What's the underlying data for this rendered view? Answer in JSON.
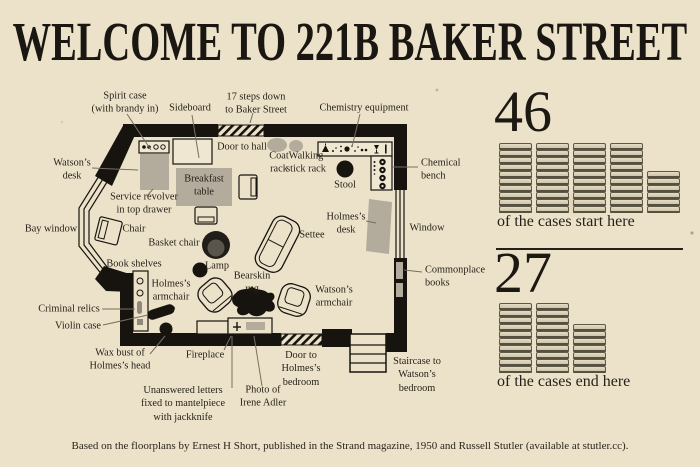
{
  "title": "WELCOME TO 221B BAKER STREET",
  "floorplan": {
    "labels": [
      {
        "id": "spirit-case",
        "text": "Spirit case\n(with brandy in)",
        "x": 125,
        "y": 103,
        "align": "center"
      },
      {
        "id": "sideboard",
        "text": "Sideboard",
        "x": 190,
        "y": 108,
        "align": "center"
      },
      {
        "id": "steps-to-baker-street",
        "text": "17 steps down\nto Baker Street",
        "x": 256,
        "y": 104,
        "align": "center"
      },
      {
        "id": "chemistry-equipment",
        "text": "Chemistry equipment",
        "x": 364,
        "y": 108,
        "align": "center"
      },
      {
        "id": "door-to-hall",
        "text": "Door to hall",
        "x": 242,
        "y": 147,
        "align": "center"
      },
      {
        "id": "coat-rack",
        "text": "Coat\nrack",
        "x": 279,
        "y": 163,
        "align": "center"
      },
      {
        "id": "walking-stick-rack",
        "text": "Walking\nstick rack",
        "x": 306,
        "y": 163,
        "align": "center"
      },
      {
        "id": "stool",
        "text": "Stool",
        "x": 345,
        "y": 185,
        "align": "center"
      },
      {
        "id": "chemical-bench",
        "text": "Chemical\nbench",
        "x": 421,
        "y": 170,
        "align": "left"
      },
      {
        "id": "watsons-desk",
        "text": "Watson’s\ndesk",
        "x": 72,
        "y": 170,
        "align": "center"
      },
      {
        "id": "service-revolver",
        "text": "Service revolver\nin top drawer",
        "x": 144,
        "y": 204,
        "align": "center"
      },
      {
        "id": "breakfast-table",
        "text": "Breakfast\ntable",
        "x": 204,
        "y": 186,
        "align": "center"
      },
      {
        "id": "bay-window",
        "text": "Bay window",
        "x": 51,
        "y": 229,
        "align": "center"
      },
      {
        "id": "chair",
        "text": "Chair",
        "x": 134,
        "y": 229,
        "align": "center"
      },
      {
        "id": "basket-chair",
        "text": "Basket chair",
        "x": 174,
        "y": 243,
        "align": "center"
      },
      {
        "id": "settee",
        "text": "Settee",
        "x": 312,
        "y": 235,
        "align": "center"
      },
      {
        "id": "holmes-desk",
        "text": "Holmes’s\ndesk",
        "x": 346,
        "y": 224,
        "align": "center"
      },
      {
        "id": "window",
        "text": "Window",
        "x": 427,
        "y": 228,
        "align": "center"
      },
      {
        "id": "book-shelves",
        "text": "Book shelves",
        "x": 134,
        "y": 264,
        "align": "center"
      },
      {
        "id": "lamp",
        "text": "Lamp",
        "x": 217,
        "y": 266,
        "align": "center"
      },
      {
        "id": "bearskin-rug",
        "text": "Bearskin\nrug",
        "x": 252,
        "y": 283,
        "align": "center"
      },
      {
        "id": "commonplace-books",
        "text": "Commonplace\nbooks",
        "x": 425,
        "y": 277,
        "align": "left"
      },
      {
        "id": "holmes-armchair",
        "text": "Holmes’s\narmchair",
        "x": 171,
        "y": 291,
        "align": "center"
      },
      {
        "id": "watsons-armchair",
        "text": "Watson’s\narmchair",
        "x": 334,
        "y": 297,
        "align": "center"
      },
      {
        "id": "criminal-relics",
        "text": "Criminal relics",
        "x": 69,
        "y": 309,
        "align": "center"
      },
      {
        "id": "violin-case",
        "text": "Violin case",
        "x": 78,
        "y": 326,
        "align": "center"
      },
      {
        "id": "wax-bust",
        "text": "Wax bust of\nHolmes’s head",
        "x": 120,
        "y": 360,
        "align": "center"
      },
      {
        "id": "fireplace",
        "text": "Fireplace",
        "x": 205,
        "y": 355,
        "align": "center"
      },
      {
        "id": "unanswered-letters",
        "text": "Unanswered letters\nfixed to mantelpiece\nwith jackknife",
        "x": 183,
        "y": 404,
        "align": "center"
      },
      {
        "id": "photo-of-irene-adler",
        "text": "Photo of\nIrene Adler",
        "x": 263,
        "y": 397,
        "align": "center"
      },
      {
        "id": "door-to-holmes-bedroom",
        "text": "Door to\nHolmes’s\nbedroom",
        "x": 301,
        "y": 369,
        "align": "center"
      },
      {
        "id": "staircase",
        "text": "Staircase to\nWatson’s\nbedroom",
        "x": 417,
        "y": 375,
        "align": "center"
      }
    ]
  },
  "stats": [
    {
      "number": "46",
      "caption": "of the cases start here",
      "stacks": [
        10,
        10,
        10,
        10,
        6
      ]
    },
    {
      "number": "27",
      "caption": "of the cases end here",
      "stacks": [
        10,
        10,
        7
      ]
    }
  ],
  "footer": {
    "credit": "Based on the floorplans by Ernest H Short, published in the Strand magazine, 1950 and Russell Stutler (available at stutler.cc)."
  },
  "colors": {
    "background": "#ece2ca",
    "ink": "#17140f",
    "furniture_gray": "#b3ab9c",
    "book_fill": "#d8cfb6"
  }
}
